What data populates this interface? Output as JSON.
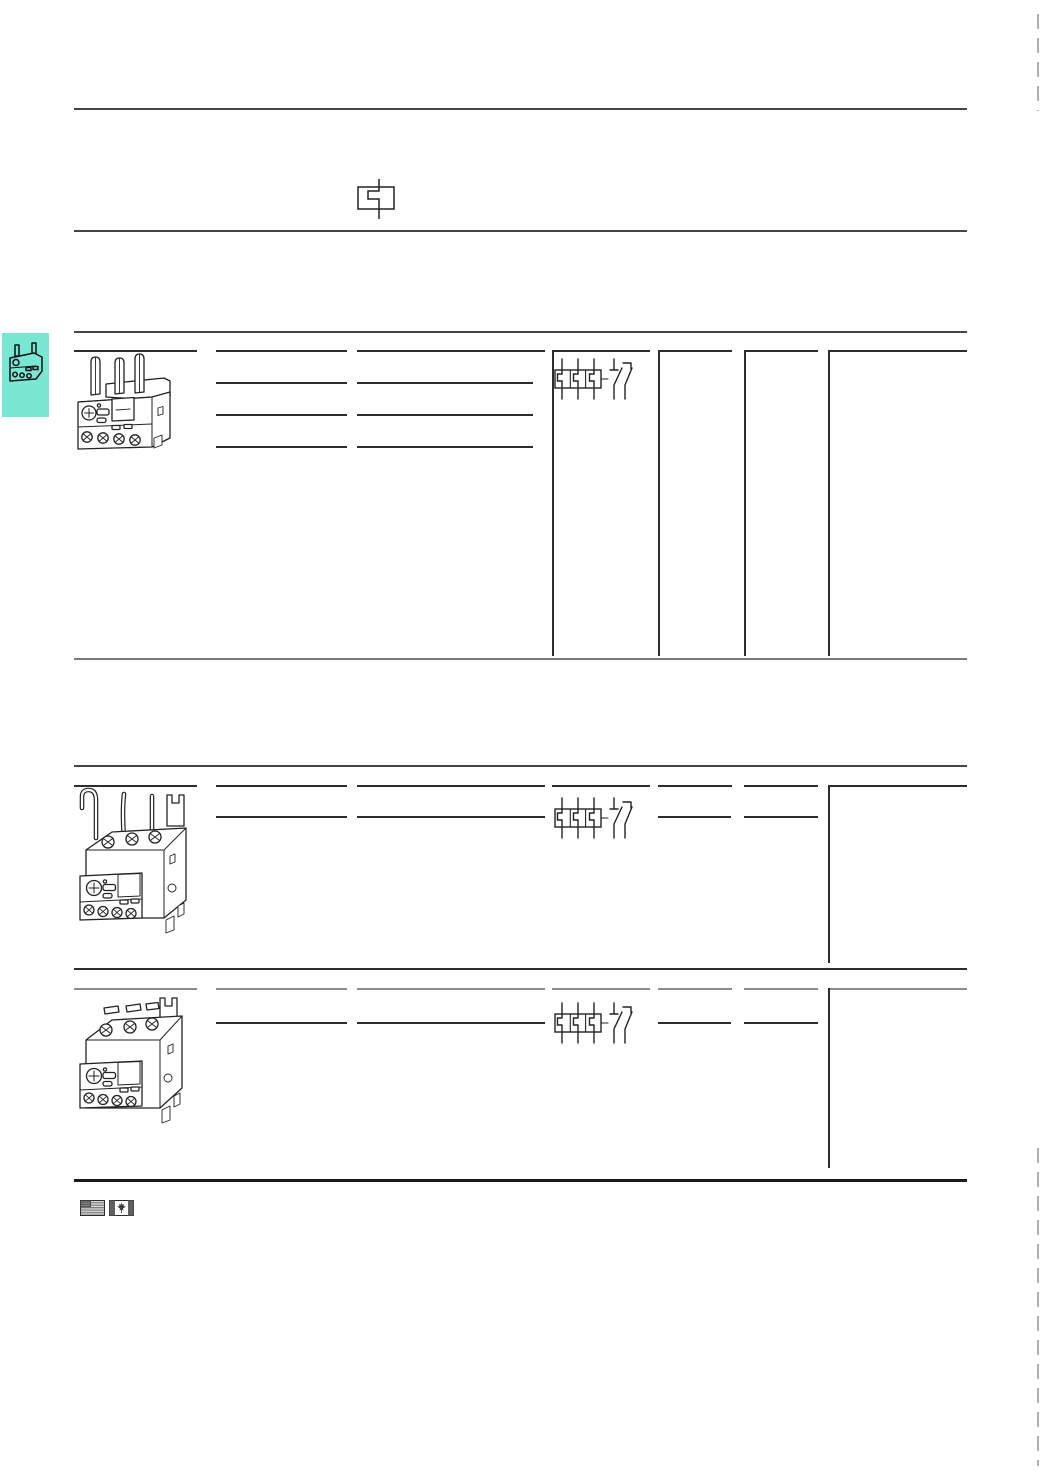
{
  "colors": {
    "accent_tab": "#79e7d2",
    "rule_dark": "#454545",
    "rule_gray": "#8c8c8c",
    "line_dark": "#2d2d2d",
    "thick_black": "#1a1a1a",
    "dash_mark": "#b0b0b0",
    "art_stroke": "#222222",
    "flag_dark": "#4f4f4f",
    "flag_stripe": "#6e6e6e",
    "flag_light": "#e9e9e9"
  },
  "icons": {
    "header_symbol": "thermal-overload-element-symbol",
    "tab_thumbnail": "overload-relay-thumbnail",
    "circuit_symbol": "3-pole-thermal-overload-relay-with-auxiliary-contacts",
    "product_1": "overload-relay-direct-mounting",
    "product_2": "overload-relay-separate-mounting-with-wires",
    "product_3": "overload-relay-separate-mounting",
    "flag_us": "us-flag",
    "flag_ca": "canada-flag"
  }
}
